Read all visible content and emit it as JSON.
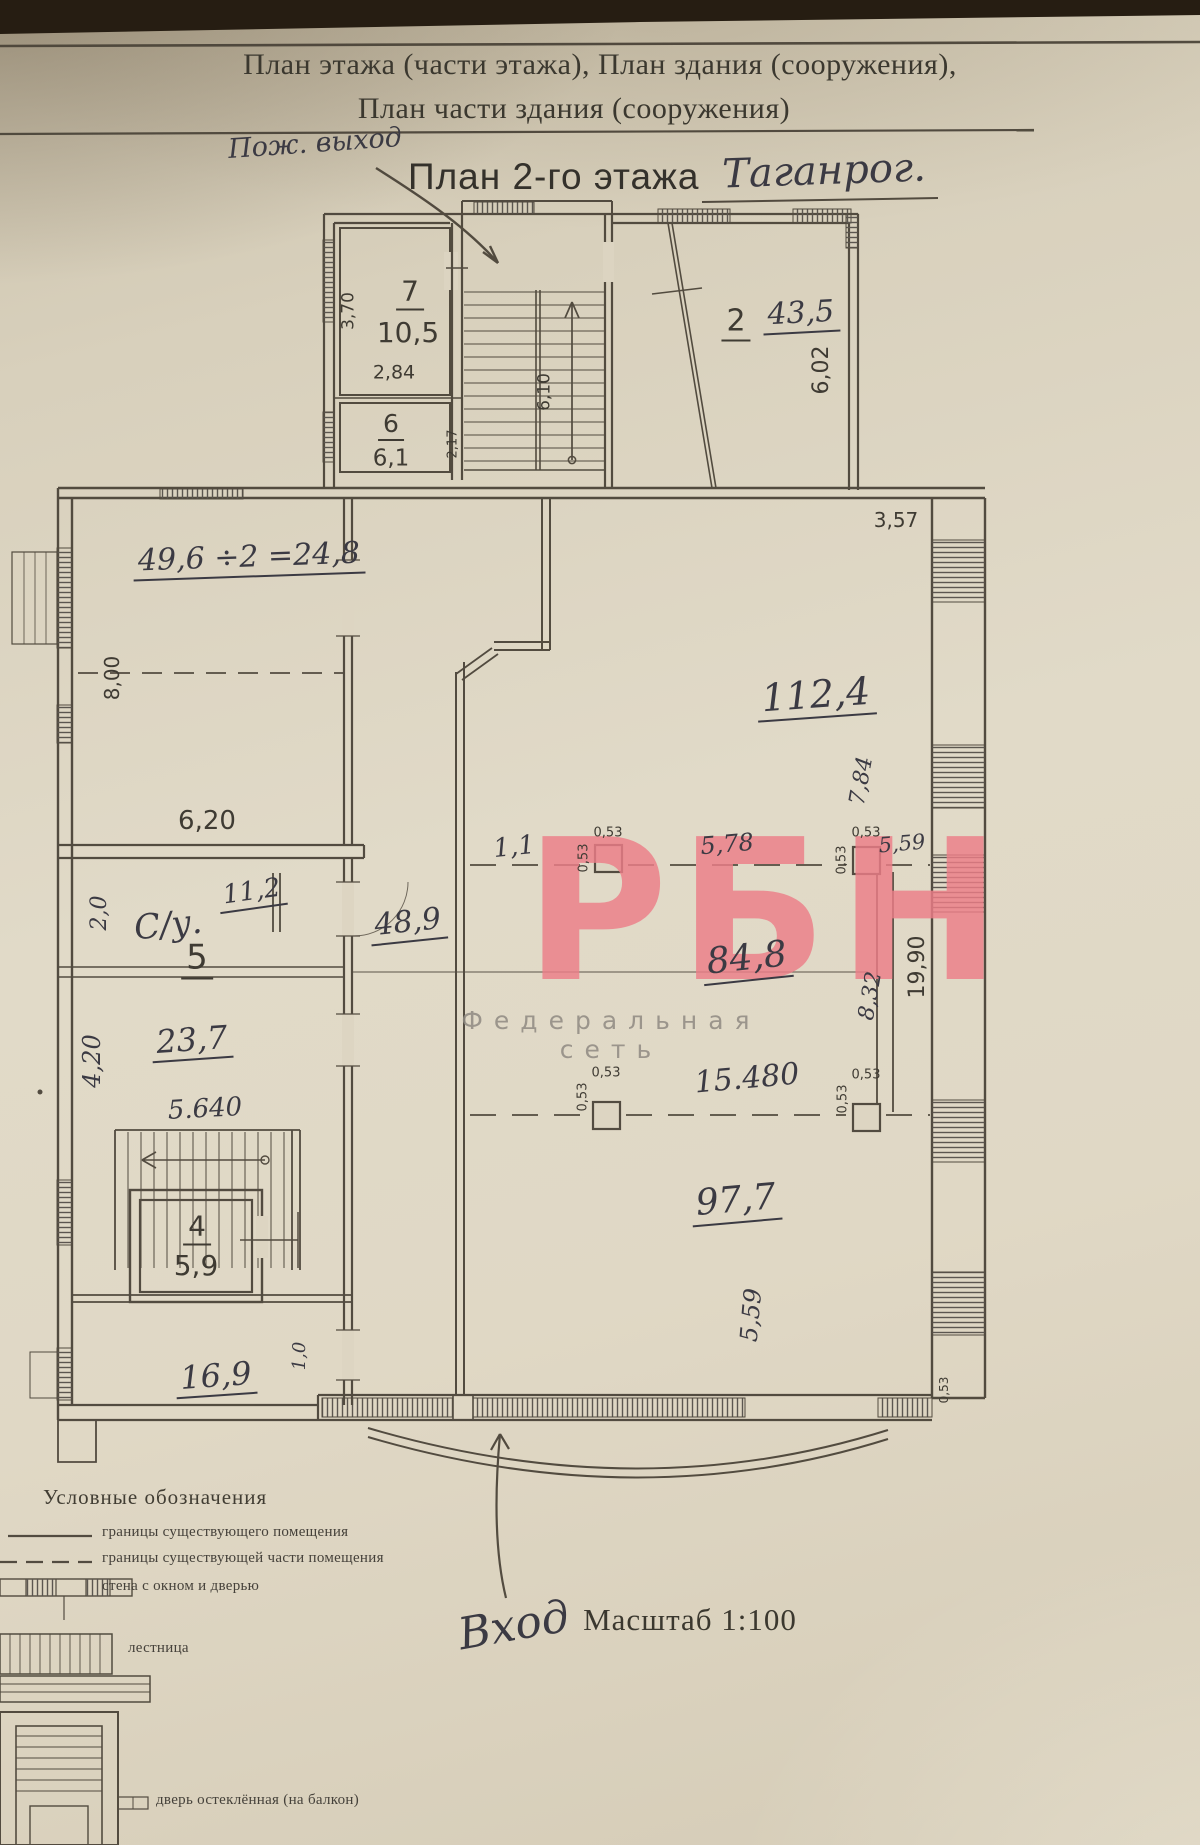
{
  "document": {
    "header_line1": "План этажа (части этажа), План здания (сооружения),",
    "header_line2": "План части здания (сооружения)",
    "title": "План 2-го этажа",
    "title_annotation": "Таганрог.",
    "scale_label": "Масштаб 1:100"
  },
  "annotations": {
    "fire_exit": "Пож. выход",
    "entrance": "Вход"
  },
  "watermark": {
    "logo": "РБН",
    "subtitle": "Федеральная сеть",
    "logo_color": "#ed7e88",
    "subtitle_color": "#8f8a82"
  },
  "legend": {
    "title": "Условные обозначения",
    "items": [
      {
        "icon": "solid-line",
        "label": "границы существующего помещения"
      },
      {
        "icon": "dashed-line",
        "label": "границы существующей части помещения"
      },
      {
        "icon": "wall-window-door",
        "label": "стена с окном и дверью"
      },
      {
        "icon": "stairs",
        "label": "лестница"
      },
      {
        "icon": "glazed-door",
        "label": "дверь остеклённая (на балкон)"
      }
    ]
  },
  "rooms": [
    {
      "number": "7",
      "area": "10,5",
      "dims": [
        "3,70",
        "2,84"
      ]
    },
    {
      "number": "6",
      "area": "6,1",
      "dims": [
        "2,17"
      ]
    },
    {
      "number": "2",
      "area": "43,5",
      "dims": [
        "6,02"
      ]
    },
    {
      "number": "5",
      "area": "23,7",
      "dims": [
        "4,20",
        "5.640"
      ]
    },
    {
      "number": "4",
      "area": "5,9",
      "dims": []
    },
    {
      "number": "",
      "area": "49,6",
      "dims": [
        "8,00",
        "6,20"
      ]
    },
    {
      "number": "С/у.",
      "area": "11,2",
      "dims": [
        "2,0"
      ]
    },
    {
      "number": "",
      "area": "16,9",
      "dims": []
    },
    {
      "number": "",
      "area": "48,9",
      "dims": []
    },
    {
      "number": "",
      "area": "112,4",
      "dims": [
        "3,57",
        "7,84"
      ]
    },
    {
      "number": "",
      "area": "84,8",
      "dims": [
        "5,78",
        "5,59",
        "8,32",
        "19,90"
      ]
    },
    {
      "number": "",
      "area": "97,7",
      "dims": [
        "15.480",
        "5,59",
        "0,53"
      ]
    }
  ],
  "plan_labels": [
    {
      "name": "room7-number",
      "text": "7",
      "x": 410,
      "y": 294,
      "size": 28,
      "font": "print",
      "rot": 0,
      "ul": true
    },
    {
      "name": "room7-area",
      "text": "10,5",
      "x": 408,
      "y": 333,
      "size": 28,
      "font": "print",
      "rot": 0,
      "ul": false
    },
    {
      "name": "room7-width-dim",
      "text": "2,84",
      "x": 394,
      "y": 373,
      "size": 19,
      "font": "print",
      "rot": 0,
      "ul": false
    },
    {
      "name": "room7-depth-dim",
      "text": "3,70",
      "x": 349,
      "y": 311,
      "size": 17,
      "font": "print",
      "rot": -90,
      "ul": false
    },
    {
      "name": "room6-number",
      "text": "6",
      "x": 391,
      "y": 426,
      "size": 25,
      "font": "print",
      "rot": 0,
      "ul": true
    },
    {
      "name": "room6-area",
      "text": "6,1",
      "x": 391,
      "y": 459,
      "size": 23,
      "font": "print",
      "rot": 0,
      "ul": false
    },
    {
      "name": "room6-depth-dim",
      "text": "2,17",
      "x": 453,
      "y": 444,
      "size": 13,
      "font": "print",
      "rot": -90,
      "ul": false
    },
    {
      "name": "stair-flight-dim",
      "text": "6,10",
      "x": 545,
      "y": 392,
      "size": 17,
      "font": "print",
      "rot": -90,
      "ul": false
    },
    {
      "name": "room2-number",
      "text": "2",
      "x": 736,
      "y": 324,
      "size": 30,
      "font": "print",
      "rot": 0,
      "ul": true
    },
    {
      "name": "room2-area",
      "text": "43,5",
      "x": 801,
      "y": 316,
      "size": 30,
      "font": "hand",
      "rot": -3,
      "ul": true
    },
    {
      "name": "room2-depth-dim",
      "text": "6,02",
      "x": 822,
      "y": 370,
      "size": 22,
      "font": "print",
      "rot": -90,
      "ul": false
    },
    {
      "name": "wall-dim-3-57",
      "text": "3,57",
      "x": 896,
      "y": 520,
      "size": 20,
      "font": "print",
      "rot": 0,
      "ul": false
    },
    {
      "name": "area-calculation-note",
      "text": "49,6 ÷2 =24,8",
      "x": 249,
      "y": 560,
      "size": 30,
      "font": "hand",
      "rot": -2,
      "ul": true
    },
    {
      "name": "room49-depth-dim",
      "text": "8,00",
      "x": 112,
      "y": 678,
      "size": 20,
      "font": "print",
      "rot": -90,
      "ul": false
    },
    {
      "name": "room49-width-dim",
      "text": "6,20",
      "x": 207,
      "y": 821,
      "size": 26,
      "font": "print",
      "rot": 0,
      "ul": false
    },
    {
      "name": "wc-width-dim",
      "text": "2,0",
      "x": 100,
      "y": 913,
      "size": 22,
      "font": "hand",
      "rot": -90,
      "ul": false
    },
    {
      "name": "wc-label",
      "text": "С/у.",
      "x": 168,
      "y": 925,
      "size": 34,
      "font": "hand",
      "rot": -6,
      "ul": false
    },
    {
      "name": "wc-area",
      "text": "11,2",
      "x": 252,
      "y": 894,
      "size": 26,
      "font": "hand",
      "rot": -8,
      "ul": true
    },
    {
      "name": "room5-number",
      "text": "5",
      "x": 197,
      "y": 960,
      "size": 34,
      "font": "print",
      "rot": 0,
      "ul": true
    },
    {
      "name": "room5-area",
      "text": "23,7",
      "x": 192,
      "y": 1042,
      "size": 32,
      "font": "hand",
      "rot": -4,
      "ul": true
    },
    {
      "name": "room5-depth-dim",
      "text": "4,20",
      "x": 92,
      "y": 1061,
      "size": 24,
      "font": "hand",
      "rot": -90,
      "ul": false
    },
    {
      "name": "dim-5-640",
      "text": "5.640",
      "x": 205,
      "y": 1109,
      "size": 26,
      "font": "hand",
      "rot": -3,
      "ul": false
    },
    {
      "name": "room4-number",
      "text": "4",
      "x": 197,
      "y": 1229,
      "size": 28,
      "font": "print",
      "rot": 0,
      "ul": true
    },
    {
      "name": "room4-area",
      "text": "5,9",
      "x": 196,
      "y": 1266,
      "size": 28,
      "font": "print",
      "rot": 0,
      "ul": false
    },
    {
      "name": "room16-area",
      "text": "16,9",
      "x": 216,
      "y": 1378,
      "size": 32,
      "font": "hand",
      "rot": -4,
      "ul": true
    },
    {
      "name": "dim-1-0",
      "text": "1,0",
      "x": 300,
      "y": 1356,
      "size": 18,
      "font": "hand",
      "rot": -90,
      "ul": false
    },
    {
      "name": "corridor-area",
      "text": "48,9",
      "x": 408,
      "y": 925,
      "size": 30,
      "font": "hand",
      "rot": -6,
      "ul": true
    },
    {
      "name": "hall-area-112-4",
      "text": "112,4",
      "x": 816,
      "y": 697,
      "size": 38,
      "font": "hand",
      "rot": -4,
      "ul": true
    },
    {
      "name": "dim-7-84",
      "text": "7,84",
      "x": 862,
      "y": 781,
      "size": 22,
      "font": "hand",
      "rot": -80,
      "ul": false
    },
    {
      "name": "dim-1-1",
      "text": "1,1",
      "x": 514,
      "y": 847,
      "size": 26,
      "font": "hand",
      "rot": -6,
      "ul": false
    },
    {
      "name": "column1-width-dim",
      "text": "0,53",
      "x": 608,
      "y": 833,
      "size": 13,
      "font": "print",
      "rot": 0,
      "ul": false
    },
    {
      "name": "column1-depth-dim",
      "text": "0,53",
      "x": 584,
      "y": 858,
      "size": 13,
      "font": "print",
      "rot": -90,
      "ul": false
    },
    {
      "name": "dim-5-78",
      "text": "5,78",
      "x": 727,
      "y": 844,
      "size": 24,
      "font": "hand",
      "rot": -5,
      "ul": false
    },
    {
      "name": "column2-width-dim",
      "text": "0,53",
      "x": 866,
      "y": 833,
      "size": 13,
      "font": "print",
      "rot": 0,
      "ul": false
    },
    {
      "name": "column2-depth-dim",
      "text": "0,53",
      "x": 842,
      "y": 860,
      "size": 13,
      "font": "print",
      "rot": -90,
      "ul": false
    },
    {
      "name": "dim-5-59-upper",
      "text": "5,59",
      "x": 902,
      "y": 844,
      "size": 21,
      "font": "hand",
      "rot": -5,
      "ul": false
    },
    {
      "name": "hall-area-84-8",
      "text": "84,8",
      "x": 747,
      "y": 961,
      "size": 36,
      "font": "hand",
      "rot": -6,
      "ul": true
    },
    {
      "name": "dim-8-32",
      "text": "8,32",
      "x": 871,
      "y": 996,
      "size": 22,
      "font": "hand",
      "rot": -80,
      "ul": false
    },
    {
      "name": "dim-15-480",
      "text": "15.480",
      "x": 747,
      "y": 1079,
      "size": 30,
      "font": "hand",
      "rot": -5,
      "ul": false
    },
    {
      "name": "column3-width-dim",
      "text": "0,53",
      "x": 606,
      "y": 1073,
      "size": 13,
      "font": "print",
      "rot": 0,
      "ul": false
    },
    {
      "name": "column3-depth-dim",
      "text": "0,53",
      "x": 583,
      "y": 1097,
      "size": 13,
      "font": "print",
      "rot": -90,
      "ul": false
    },
    {
      "name": "column4-width-dim",
      "text": "0,53",
      "x": 866,
      "y": 1075,
      "size": 13,
      "font": "print",
      "rot": 0,
      "ul": false
    },
    {
      "name": "column4-depth-dim",
      "text": "0,53",
      "x": 843,
      "y": 1099,
      "size": 13,
      "font": "print",
      "rot": -90,
      "ul": false
    },
    {
      "name": "hall-area-97-7",
      "text": "97,7",
      "x": 736,
      "y": 1203,
      "size": 36,
      "font": "hand",
      "rot": -5,
      "ul": true
    },
    {
      "name": "dim-5-59-lower",
      "text": "5,59",
      "x": 751,
      "y": 1315,
      "size": 24,
      "font": "hand",
      "rot": -85,
      "ul": false
    },
    {
      "name": "wall-dim-19-90",
      "text": "19,90",
      "x": 918,
      "y": 967,
      "size": 22,
      "font": "print",
      "rot": -90,
      "ul": false
    },
    {
      "name": "corner-dim-0-53",
      "text": "0,53",
      "x": 944,
      "y": 1390,
      "size": 12,
      "font": "print",
      "rot": -90,
      "ul": false
    }
  ]
}
